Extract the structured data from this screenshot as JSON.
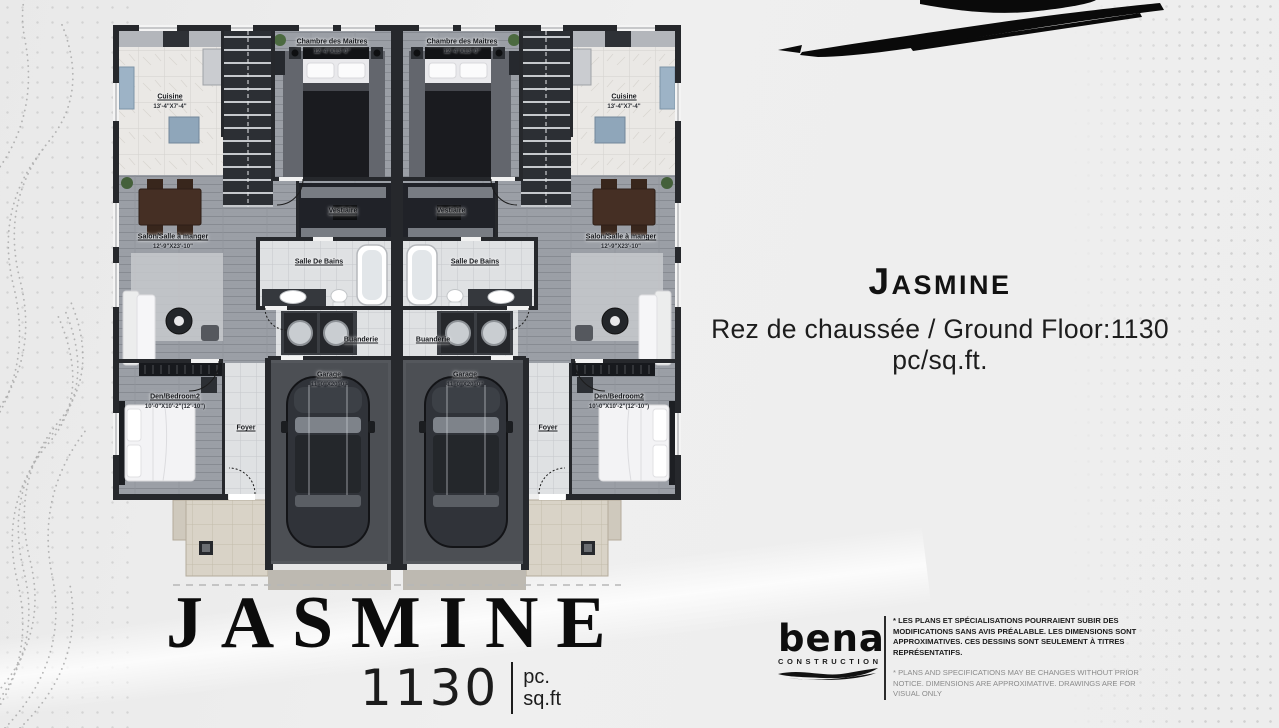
{
  "colors": {
    "background": "#ededed",
    "ink": "#0c0c0c",
    "wall": "#26282c",
    "accent_blue": "#9db3c6"
  },
  "title_block": {
    "name": "Jasmine",
    "subtitle": "Rez de chaussée / Ground Floor:1130 pc/sq.ft."
  },
  "footer": {
    "plan_name": "JASMINE",
    "area_value": "1130",
    "unit_top": "pc.",
    "unit_bottom": "sq.ft"
  },
  "brand": {
    "name": "bena",
    "tagline": "CONSTRUCTION"
  },
  "disclaimers": {
    "fr": "* LES PLANS ET SPÉCIALISATIONS POURRAIENT SUBIR DES MODIFICATIONS SANS AVIS PRÉALABLE. LES DIMENSIONS SONT APPROXIMATIVES. CES DESSINS SONT SEULEMENT À TITRES REPRÉSENTATIFS.",
    "en": "* PLANS AND SPECIFICATIONS MAY BE CHANGES WITHOUT PRIOR NOTICE. DIMENSIONS ARE APPROXIMATIVE. DRAWINGS ARE FOR VISUAL ONLY"
  },
  "floor_plan": {
    "rooms": {
      "chambre": {
        "label": "Chambre des Maitres",
        "dim": "12'-4\"X13'-0\""
      },
      "cuisine": {
        "label": "Cuisine",
        "dim": "13'-4\"X7'-4\""
      },
      "vestiaire": {
        "label": "Vestiaire"
      },
      "salle_de_bains": {
        "label": "Salle De Bains"
      },
      "salon": {
        "label": "Salon/Salle à manger",
        "dim": "12'-9\"X23'-10\""
      },
      "buanderie": {
        "label": "Buanderie"
      },
      "garage": {
        "label": "Garage",
        "dim": "11'-0\"X20'-0\""
      },
      "den": {
        "label": "Den/Bedroom2",
        "dim": "10'-0\"X10'-2\"(12'-10\")"
      },
      "foyer": {
        "label": "Foyer"
      }
    }
  }
}
